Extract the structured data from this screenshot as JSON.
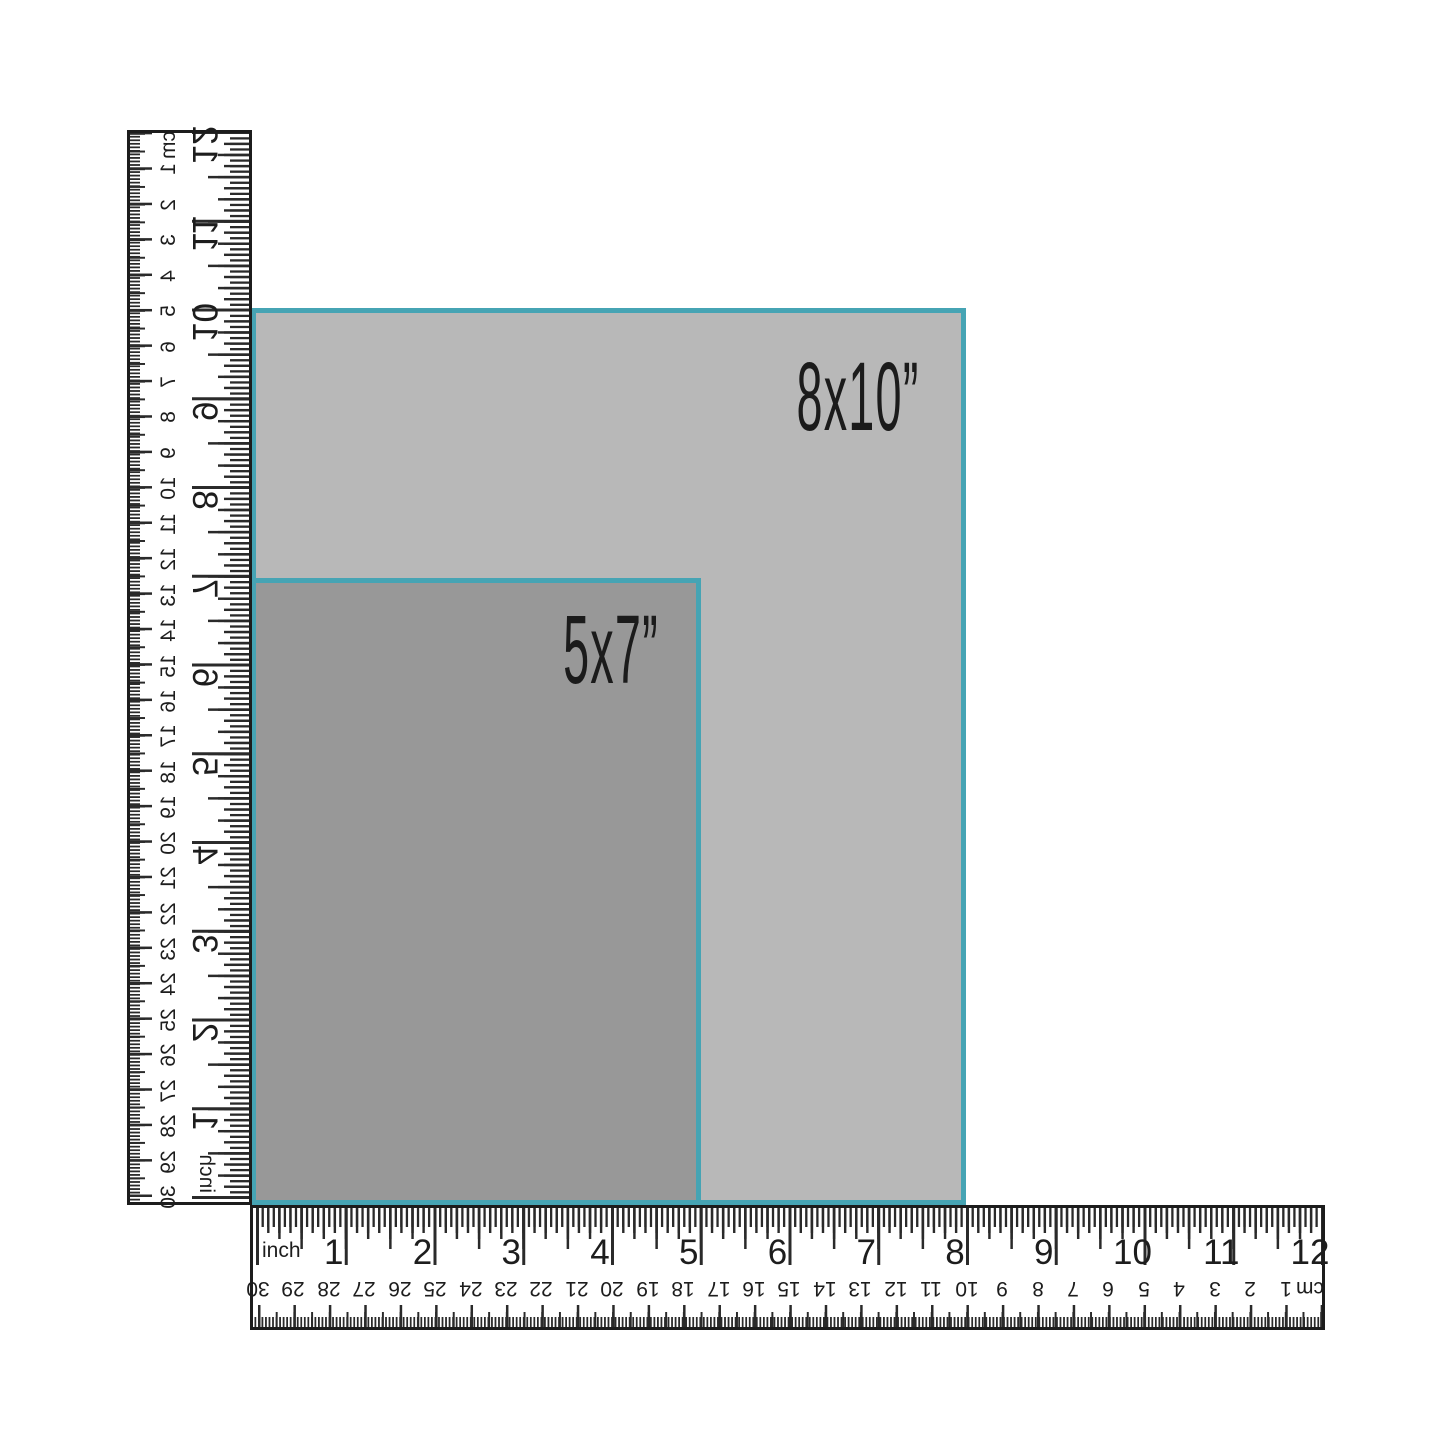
{
  "canvas": {
    "background": "#ffffff"
  },
  "sizes": [
    {
      "label": "8x10”",
      "width_in": 8,
      "height_in": 10,
      "fill": "#b8b8b8",
      "border_color": "#46a4b4",
      "text_color": "#1b1b1b"
    },
    {
      "label": "5x7”",
      "width_in": 5,
      "height_in": 7,
      "fill": "#989898",
      "border_color": "#46a4b4",
      "text_color": "#1b1b1b"
    }
  ],
  "ruler": {
    "unit_inch_label": "inch",
    "unit_cm_label": "cm",
    "inches_total": 12,
    "cm_total": 30,
    "inch_labels": [
      "1",
      "2",
      "3",
      "4",
      "5",
      "6",
      "7",
      "8",
      "9",
      "10",
      "11",
      "12"
    ],
    "cm_labels": [
      "1",
      "2",
      "3",
      "4",
      "5",
      "6",
      "7",
      "8",
      "9",
      "10",
      "11",
      "12",
      "13",
      "14",
      "15",
      "16",
      "17",
      "18",
      "19",
      "20",
      "21",
      "22",
      "23",
      "24",
      "25",
      "26",
      "27",
      "28",
      "29",
      "30"
    ],
    "body_color": "#ffffff",
    "tick_color": "#2a2a2a",
    "cm_scale_orientation": "upside-down",
    "vertical_ruler_orientation": "rotated-90-and-mirrored"
  }
}
